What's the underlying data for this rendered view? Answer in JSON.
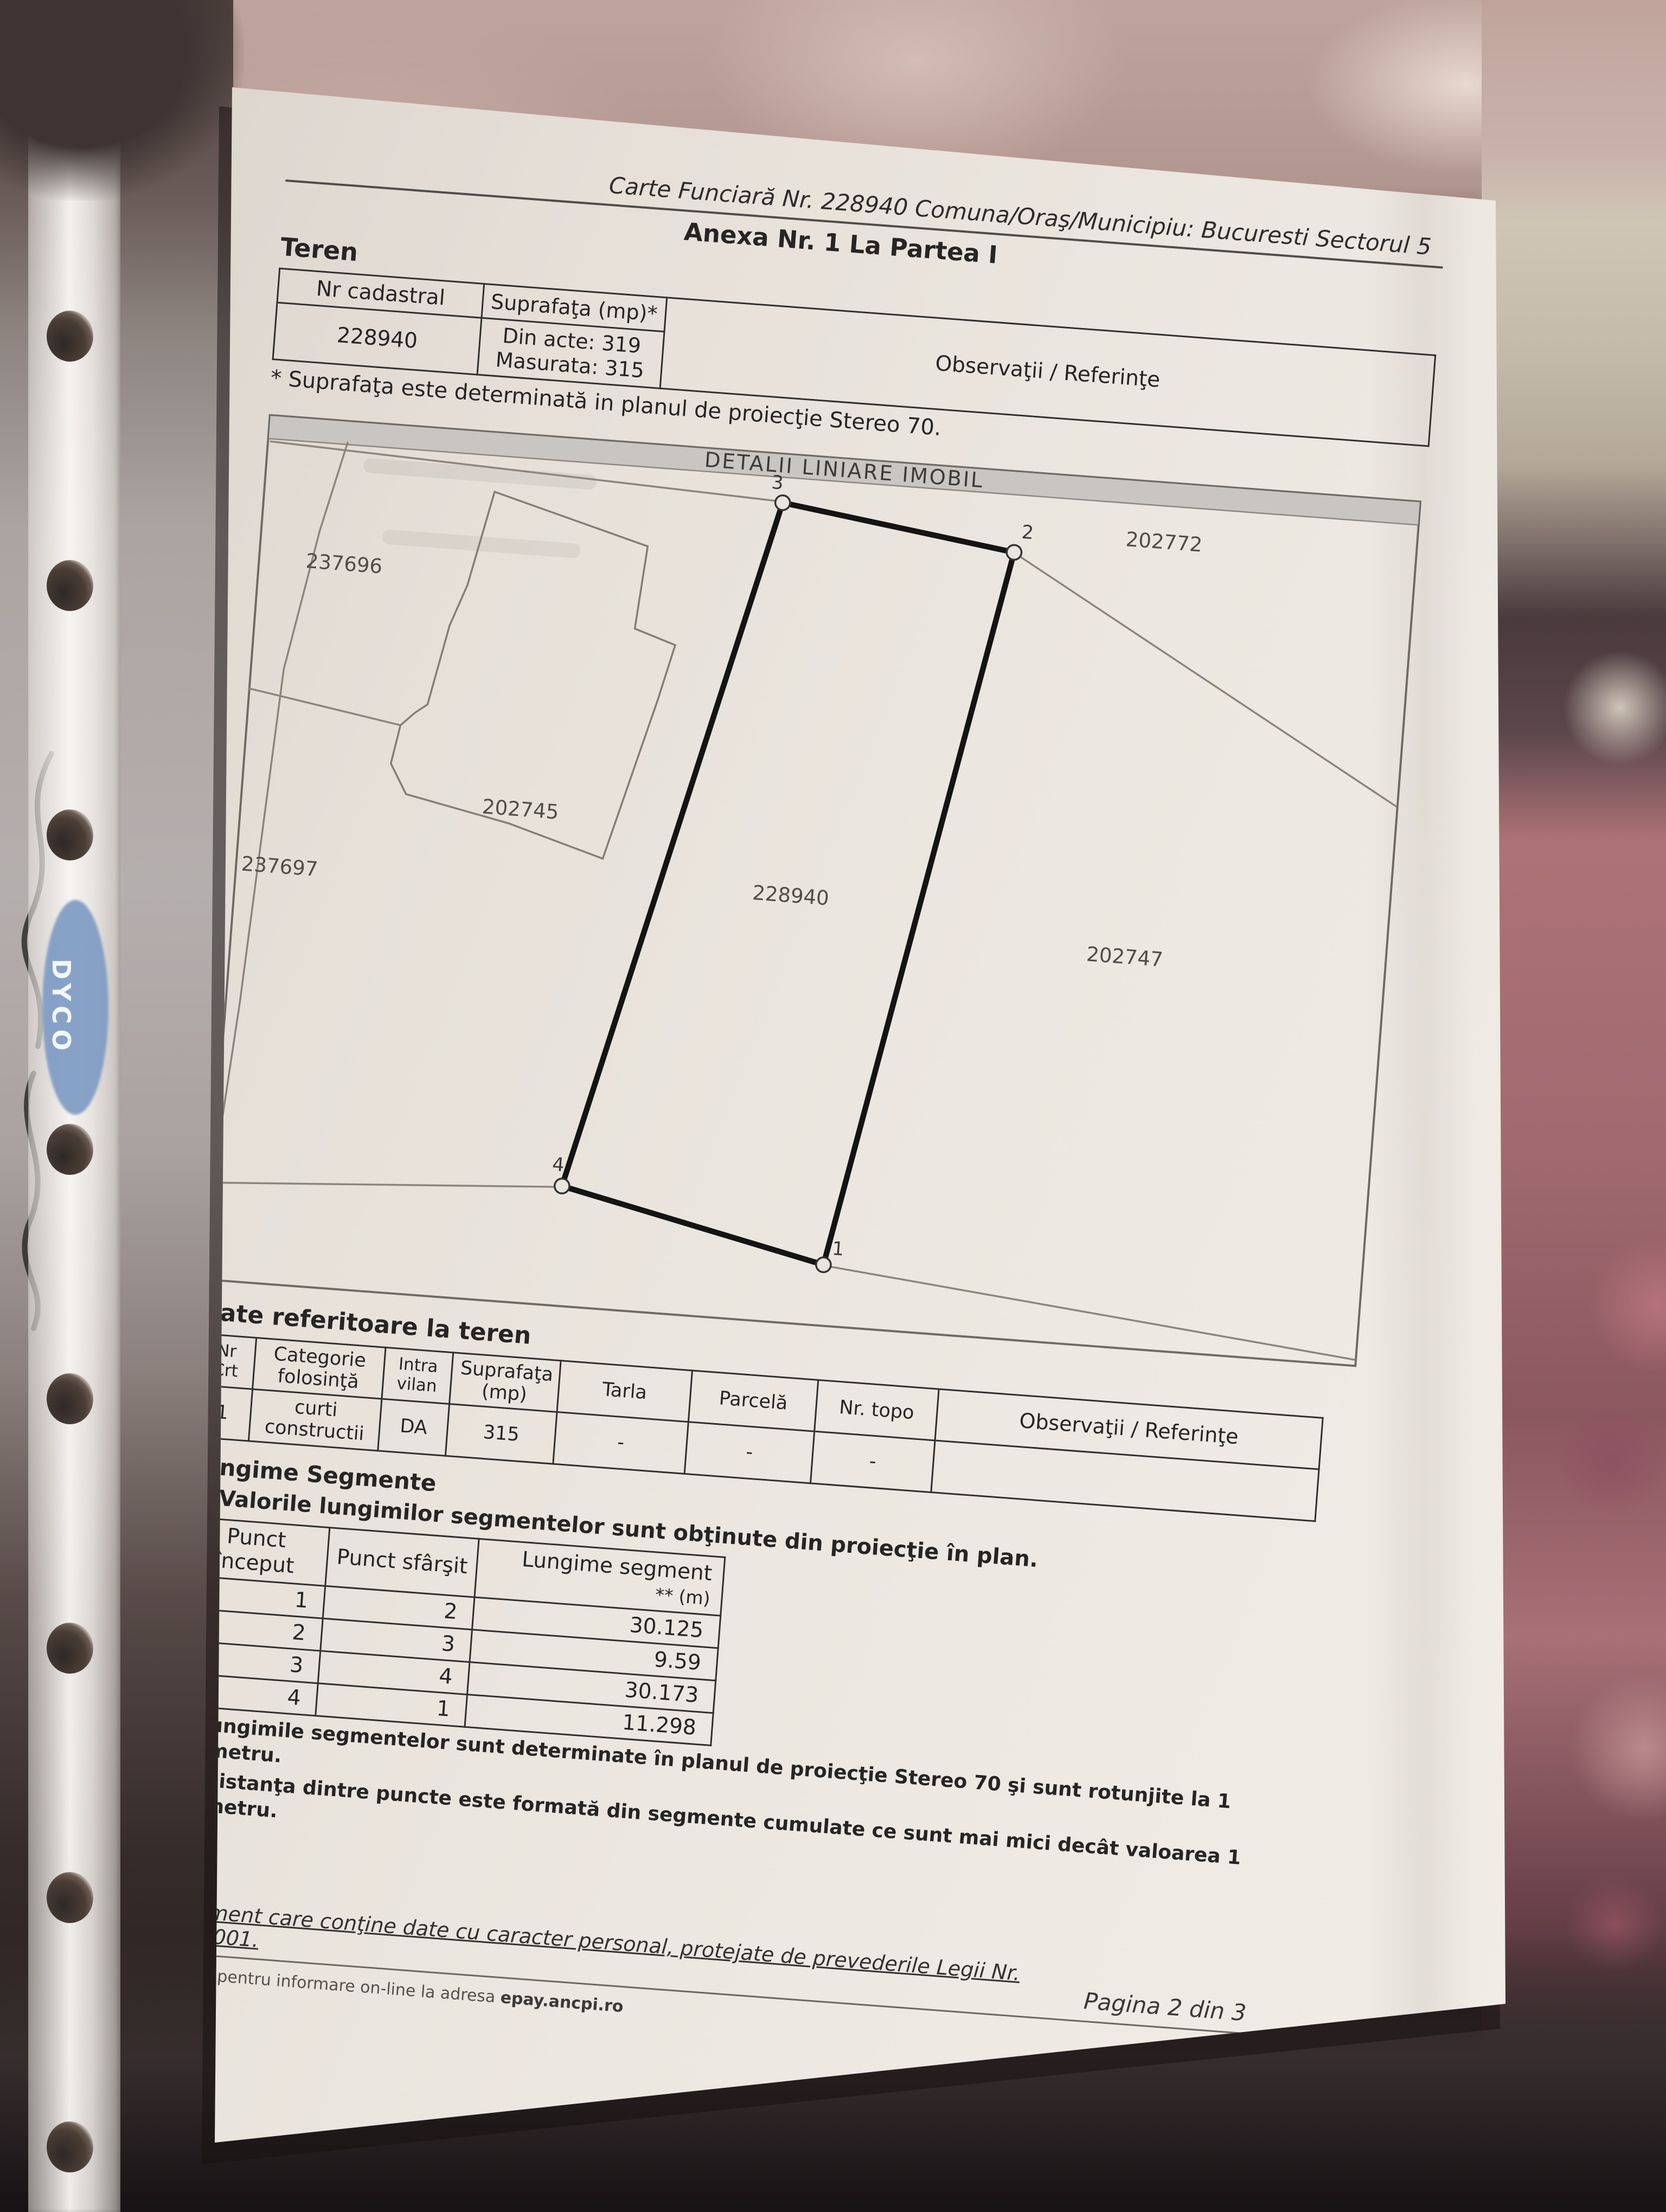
{
  "header": {
    "carte_funciara": "Carte Funciară Nr. 228940 Comuna/Oraş/Municipiu: Bucuresti Sectorul 5",
    "anexa": "Anexa Nr. 1 La Partea I"
  },
  "teren": {
    "heading": "Teren",
    "table": {
      "col_nr_cadastral": "Nr cadastral",
      "col_suprafata": "Suprafaţa (mp)*",
      "col_observatii": "Observaţii / Referinţe",
      "nr_cadastral": "228940",
      "din_acte": "Din acte: 319",
      "masurata": "Masurata: 315"
    },
    "footnote": "* Suprafaţa este determinată in planul de proiecţie Stereo 70."
  },
  "map": {
    "title": "DETALII LINIARE IMOBIL",
    "labels": {
      "left_top": "237696",
      "building": "202745",
      "left_bottom": "237697",
      "parcel": "228940",
      "right_top": "202772",
      "right": "202747"
    },
    "vertices": {
      "v1": "1",
      "v2": "2",
      "v3": "3",
      "v4": "4"
    }
  },
  "date_teren": {
    "heading": "Date referitoare la teren",
    "headers": [
      "Nr Crt",
      "Categorie folosinţă",
      "Intra vilan",
      "Suprafaţa (mp)",
      "Tarla",
      "Parcelă",
      "Nr. topo",
      "Observaţii / Referinţe"
    ],
    "row": [
      "1",
      "curti constructii",
      "DA",
      "315",
      "-",
      "-",
      "-",
      ""
    ]
  },
  "segments": {
    "heading": "Lungime Segmente",
    "note": "1) Valorile lungimilor segmentelor sunt obţinute din proiecţie în plan.",
    "col_start": "Punct început",
    "col_end": "Punct sfârşit",
    "col_len": "Lungime segment",
    "col_len_unit": "** (m)",
    "rows": [
      [
        "1",
        "2",
        "30.125"
      ],
      [
        "2",
        "3",
        "9.59"
      ],
      [
        "3",
        "4",
        "30.173"
      ],
      [
        "4",
        "1",
        "11.298"
      ]
    ],
    "footnote2": "** Lungimile segmentelor sunt determinate în planul de proiecţie Stereo 70 şi sunt rotunjite la 1 milimetru.",
    "footnote3": "*** Distanţa dintre puncte este formată din segmente cumulate ce sunt mai mici decât valoarea 1 milimetru."
  },
  "footer": {
    "privacy": "Document care conţine date cu caracter personal, protejate de prevederile Legii Nr. 677/2001.",
    "extras_prefix": "Extrase pentru informare on-line la adresa ",
    "extras_site": "epay.ancpi.ro",
    "page": "Pagina 2 din 3",
    "form_version": "Formular versiunea 1.1"
  },
  "protector": {
    "logo": "DYCO"
  }
}
